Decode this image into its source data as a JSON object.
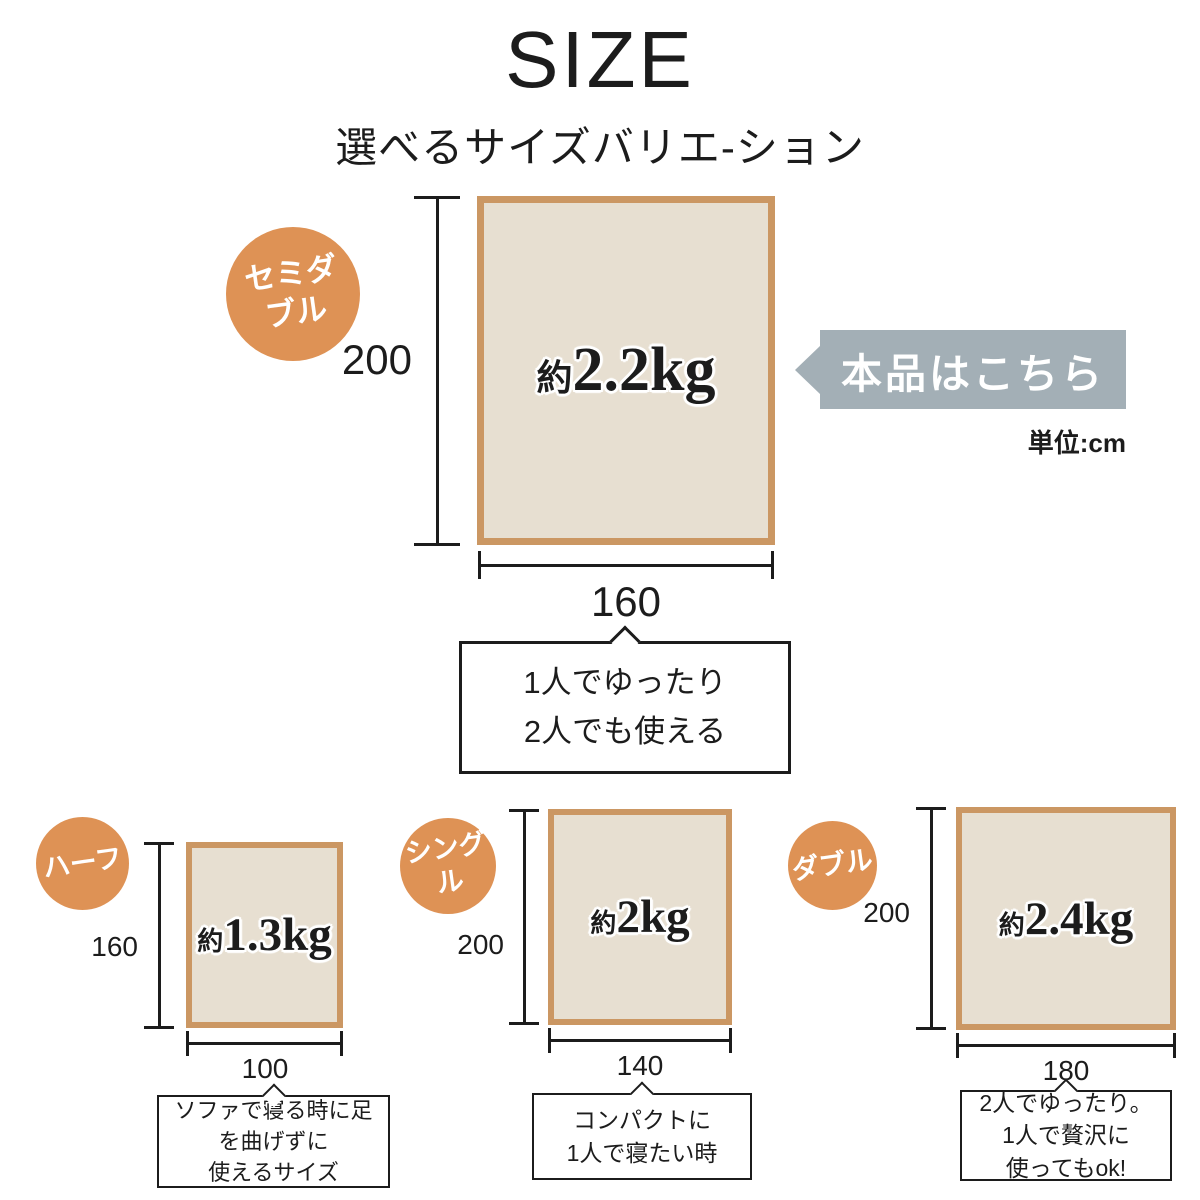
{
  "title": "SIZE",
  "subtitle": "選べるサイズバリエ-ション",
  "unit_label": "単位:cm",
  "callout": {
    "text": "本品はこちら"
  },
  "colors": {
    "badge_orange": "#DE9255",
    "blanket_border": "#CB9763",
    "blanket_fill": "#E7DFD1",
    "callout_bg": "#A3AFB6",
    "line": "#1C1C1C"
  },
  "main": {
    "name": "セミダブル",
    "badge_line1": "セミダ",
    "badge_line2": "ブル",
    "height": "200",
    "width": "160",
    "weight_prefix": "約",
    "weight_value": "2.2kg",
    "caption_lines": [
      "1人でゆったり",
      "2人でも使える"
    ]
  },
  "variants": [
    {
      "name": "ハーフ",
      "height": "160",
      "width": "100",
      "weight_prefix": "約",
      "weight_value": "1.3kg",
      "caption_lines": [
        "ソファで寝る時に足",
        "を曲げずに",
        "使えるサイズ"
      ]
    },
    {
      "name": "シングル",
      "height": "200",
      "width": "140",
      "weight_prefix": "約",
      "weight_value": "2kg",
      "caption_lines": [
        "コンパクトに",
        "1人で寝たい時"
      ]
    },
    {
      "name": "ダブル",
      "height": "200",
      "width": "180",
      "weight_prefix": "約",
      "weight_value": "2.4kg",
      "caption_lines": [
        "2人でゆったり。",
        "1人で贅沢に",
        "使ってもok!"
      ]
    }
  ]
}
